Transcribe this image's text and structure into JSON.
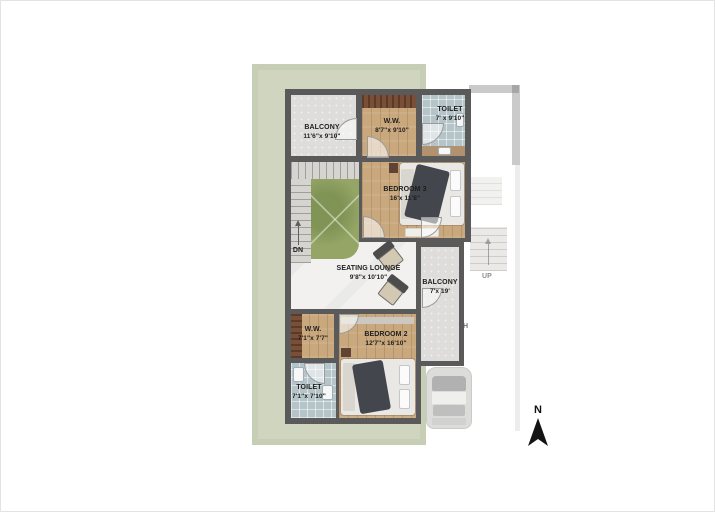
{
  "plan": {
    "type": "floor-plan",
    "rooms": [
      {
        "id": "balcony-top",
        "name": "BALCONY",
        "dims": "11'6\"x 9'10\""
      },
      {
        "id": "ww-top",
        "name": "W.W.",
        "dims": "8'7\"x 9'10\""
      },
      {
        "id": "toilet-top",
        "name": "TOILET",
        "dims": "7' x 9'10\""
      },
      {
        "id": "bedroom-3",
        "name": "BEDROOM 3",
        "dims": "16'x 11'8\""
      },
      {
        "id": "seating-lounge",
        "name": "SEATING LOUNGE",
        "dims": "9'8\"x 10'10\""
      },
      {
        "id": "balcony-right",
        "name": "BALCONY",
        "dims": "7'x 19'"
      },
      {
        "id": "ww-bottom",
        "name": "W.W.",
        "dims": "7'1\"x 7'7\""
      },
      {
        "id": "bedroom-2",
        "name": "BEDROOM 2",
        "dims": "12'7\"x 16'10\""
      },
      {
        "id": "toilet-bottom",
        "name": "TOILET",
        "dims": "7'1\"x 7'10\""
      }
    ],
    "stairs": {
      "down_label": "DN",
      "up_label": "UP"
    },
    "ghost": {
      "porch_partial_text": "CH"
    },
    "compass": {
      "north_label": "N"
    },
    "colors": {
      "plot_green": "#cfd5bf",
      "wall": "#5a5a5a",
      "wood_floor": "#c9a87e",
      "tile_floor": "#b5c4c9",
      "marble_floor": "#f2f1ef",
      "lawn_green": "#94a565",
      "balcony_gray": "#dedddb",
      "wardrobe_wood": "#7a4f38",
      "blanket_dark": "#43464c"
    }
  }
}
